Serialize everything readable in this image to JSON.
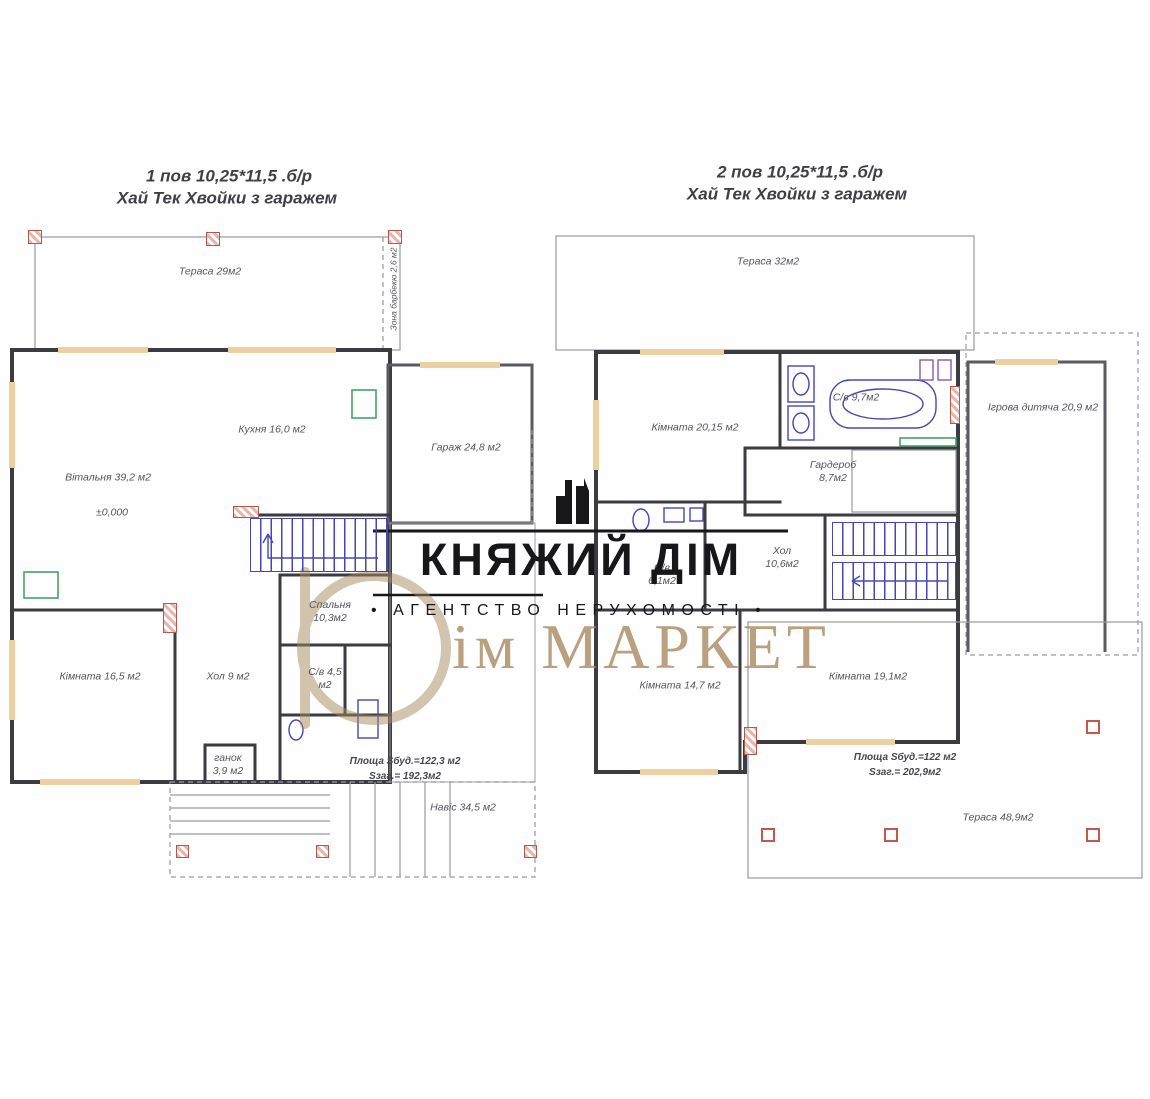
{
  "plans": {
    "left": {
      "title_line1": "1 пов 10,25*11,5 .б/р",
      "title_line2": "Хай Тек Хвойки з гаражем",
      "labels": {
        "terrace": "Тераса 29м2",
        "bbq": "Зона барбекю 2,6 м2",
        "kitchen": "Кухня 16,0 м2",
        "living_room": "Вітальня 39,2 м2",
        "elevation_mark": "±0,000",
        "garage": "Гараж 24,8 м2",
        "bedroom": "Спальня 10,3м2",
        "room": "Кімната 16,5 м2",
        "hall": "Хол 9 м2",
        "bathroom": "С/в 4,5 м2",
        "porch": "ганок 3,9 м2",
        "area_line1": "Площа Sбуд.=122,3 м2",
        "area_line2": "Sзаг.= 192,3м2",
        "canopy": "Навіс 34,5 м2"
      }
    },
    "right": {
      "title_line1": "2 пов 10,25*11,5 .б/р",
      "title_line2": "Хай Тек Хвойки з гаражем",
      "labels": {
        "terrace_top": "Тераса 32м2",
        "room1": "Кімната 20,15 м2",
        "bathroom_top": "С/в 9,7м2",
        "wardrobe": "Гардероб 8,7м2",
        "playroom": "Ігрова дитяча 20,9 м2",
        "bathroom_mid": "С/в 6,1м2",
        "hall": "Хол 10,6м2",
        "room2": "Кімната 14,7 м2",
        "room3": "Кімната 19,1м2",
        "area_line1": "Площа Sбуд.=122 м2",
        "area_line2": "Sзаг.= 202,9м2",
        "terrace_bottom": "Тераса 48,9м2"
      }
    }
  },
  "watermarks": {
    "agency": {
      "name": "КНЯЖИЙ ДІМ",
      "tagline": "АГЕНТСТВО НЕРУХОМОСТІ",
      "bullet": "•",
      "color": "#17171a"
    },
    "market": {
      "name_rest": "ім МАРКЕТ",
      "color": "#a8895f"
    }
  },
  "colors": {
    "walls": "#3b3b42",
    "stairs_fixtures_blue": "#4646b8",
    "window_sill_tan": "#ecd0a2",
    "post_red": "#b2594c",
    "fixture_green": "#47a06b",
    "watermark_bronze": "#a8895f",
    "watermark_black": "#17171a"
  }
}
